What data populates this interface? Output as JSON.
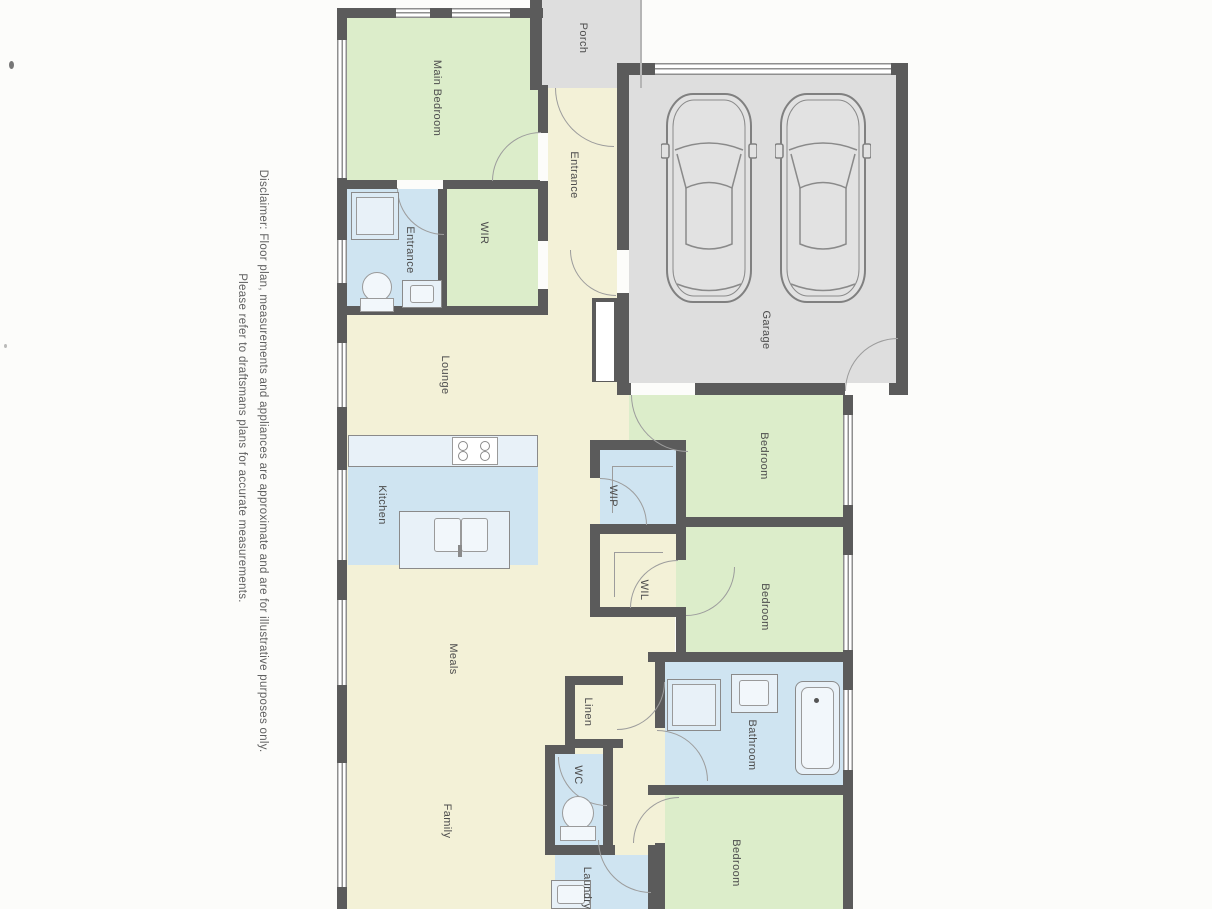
{
  "disclaimer": {
    "line1": "Disclaimer: Floor plan, measurements and appliances are approximate and are for illustrative purposes only.",
    "line2": "Please refer to draftsmans plans for accurate measurements."
  },
  "rooms": {
    "porch": "Porch",
    "main_bedroom": "Main Bedroom",
    "ensuite": "Entrance",
    "wir": "WIR",
    "entrance_hall": "Entrance",
    "garage": "Garage",
    "lounge": "Lounge",
    "kitchen": "Kitchen",
    "wip": "WIP",
    "wil": "WIL",
    "bedroom2": "Bedroom",
    "bedroom3": "Bedroom",
    "meals": "Meals",
    "linen": "Linen",
    "wc": "WC",
    "bathroom": "Bathroom",
    "family": "Family",
    "laundry": "Laundry",
    "bedroom4": "Bedroom"
  },
  "icons": {
    "car": "car-top-view",
    "toilet": "toilet-plan-symbol",
    "shower": "shower-tray-symbol",
    "bathtub": "bathtub-symbol",
    "sink": "double-sink-symbol",
    "cooktop": "four-burner-cooktop-symbol"
  },
  "colors": {
    "paper": "#fcfcfa",
    "living_cream": "#f3f1d7",
    "bedroom_green": "#dcedca",
    "wet_blue": "#cfe4f1",
    "garage_grey": "#dedede",
    "wall": "#5b5b5b"
  }
}
